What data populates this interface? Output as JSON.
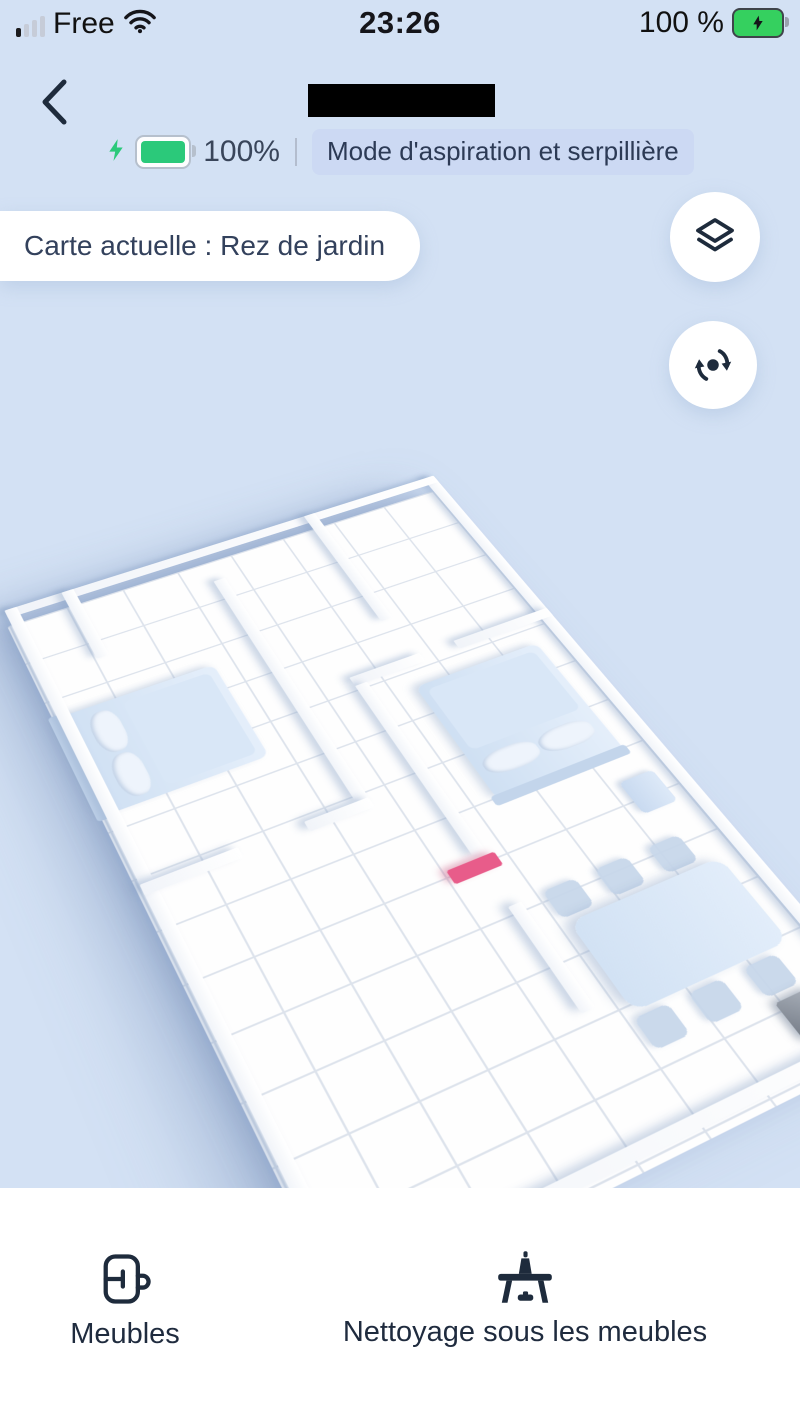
{
  "status_bar": {
    "carrier": "Free",
    "time": "23:26",
    "battery": "100 %"
  },
  "header": {
    "title_redacted": true
  },
  "device_status": {
    "battery_percent": "100%",
    "mode_badge": "Mode d'aspiration et serpillière"
  },
  "map": {
    "current_map_label": "Carte actuelle : Rez de jardin",
    "objects": [
      "bed",
      "bed",
      "nightstand",
      "dining table",
      "chairs",
      "charging dock",
      "pink marker"
    ]
  },
  "bottom_bar": {
    "items": [
      {
        "label": "Meubles"
      },
      {
        "label": "Nettoyage sous les meubles"
      }
    ]
  },
  "colors": {
    "background": "#d3e1f4",
    "badge_bg": "#ccd9f3",
    "pill_bg": "#ffffff",
    "icon_navy": "#1e2b3c",
    "device_battery_green": "#2bc97a",
    "status_battery_green": "#35d05f",
    "map_object_blue": "#d9e6f6",
    "pink_marker": "#e85c8a",
    "dock_gray": "#8f959e"
  }
}
